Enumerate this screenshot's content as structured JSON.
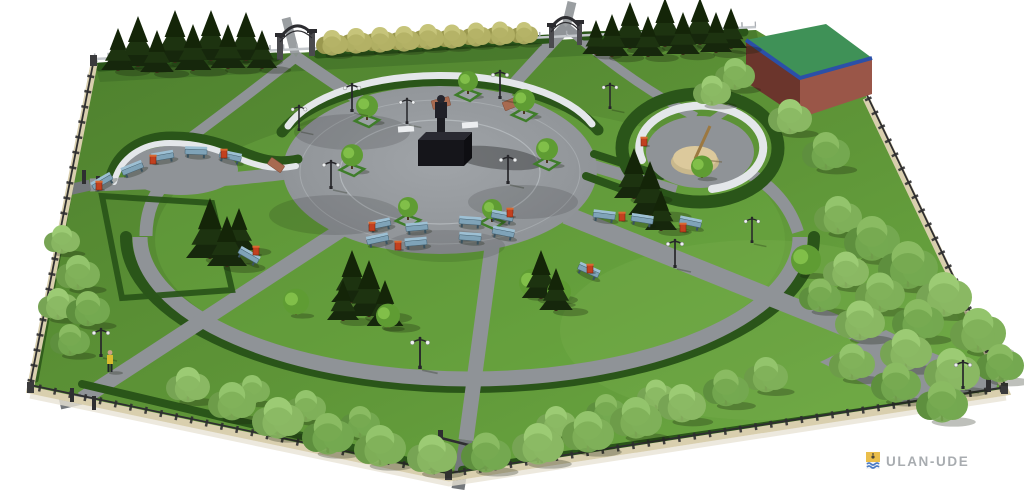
{
  "watermark": {
    "text": "ULAN-UDE"
  },
  "palette": {
    "bg": "#ffffff",
    "lawn_dark": "#4d7f2d",
    "lawn": "#5f9638",
    "lawn_bright": "#6fae45",
    "hedge": "#2a5519",
    "hedge_dark": "#1c3d10",
    "path": "#8f9397",
    "path_dark": "#74787c",
    "path_light": "#a7abaf",
    "plaza_light": "#a0a4a8",
    "plaza": "#8c9094",
    "wall": "#e4e7ea",
    "stone": "#d9cfae",
    "fence": "#2e2e30",
    "rail_light": "#c3c7cb",
    "bench": "#7fa3b8",
    "bench_back": "#9dc0d4",
    "bench_leg": "#39525f",
    "bin": "#c2401f",
    "bin_top": "#d96a33",
    "statue": "#15151a",
    "sundial_base": "#dcc99c",
    "gnomon": "#9c7840",
    "roof": "#3f9157",
    "roof_trim": "#2b50a8",
    "wall_maroon": "#6b352c",
    "wall_pink": "#9a5648",
    "steps": "#a86a50",
    "shadow": "rgba(20,28,12,0.28)",
    "watermark_text": "#898f94",
    "crest_gold": "#e9b93c",
    "crest_blue": "#3a6fc0"
  },
  "scene": {
    "trees": [
      [
        "c",
        118,
        70,
        42
      ],
      [
        "c",
        138,
        66,
        50
      ],
      [
        "c",
        157,
        72,
        42
      ],
      [
        "c",
        175,
        62,
        52
      ],
      [
        "c",
        193,
        70,
        46
      ],
      [
        "c",
        211,
        60,
        50
      ],
      [
        "c",
        228,
        68,
        44
      ],
      [
        "c",
        246,
        60,
        48
      ],
      [
        "c",
        262,
        68,
        38
      ],
      [
        "c",
        596,
        54,
        34
      ],
      [
        "c",
        612,
        56,
        42
      ],
      [
        "c",
        630,
        48,
        46
      ],
      [
        "c",
        648,
        56,
        40
      ],
      [
        "c",
        665,
        46,
        48
      ],
      [
        "c",
        683,
        54,
        42
      ],
      [
        "c",
        700,
        44,
        46
      ],
      [
        "c",
        716,
        52,
        40
      ],
      [
        "c",
        731,
        48,
        40
      ],
      [
        "c",
        210,
        258,
        60
      ],
      [
        "c",
        227,
        266,
        50
      ],
      [
        "c",
        239,
        250,
        42
      ],
      [
        "c",
        352,
        302,
        52
      ],
      [
        "c",
        369,
        316,
        56
      ],
      [
        "c",
        385,
        326,
        46
      ],
      [
        "c",
        343,
        320,
        40
      ],
      [
        "c",
        541,
        298,
        48
      ],
      [
        "c",
        556,
        310,
        42
      ],
      [
        "c",
        634,
        198,
        50
      ],
      [
        "c",
        650,
        215,
        54
      ],
      [
        "c",
        661,
        230,
        40
      ],
      [
        "d",
        838,
        232,
        24
      ],
      [
        "d",
        872,
        258,
        28
      ],
      [
        "d",
        908,
        286,
        30
      ],
      [
        "d",
        944,
        314,
        28
      ],
      [
        "d",
        978,
        350,
        28
      ],
      [
        "d",
        1000,
        380,
        24
      ],
      [
        "d",
        918,
        338,
        26
      ],
      [
        "d",
        880,
        310,
        25
      ],
      [
        "d",
        846,
        286,
        23
      ],
      [
        "d",
        952,
        390,
        28
      ],
      [
        "d",
        906,
        368,
        26
      ],
      [
        "d",
        860,
        338,
        25
      ],
      [
        "d",
        820,
        310,
        21
      ],
      [
        "d",
        942,
        420,
        26
      ],
      [
        "d",
        896,
        400,
        25
      ],
      [
        "d",
        852,
        378,
        23
      ],
      [
        "d",
        188,
        400,
        22
      ],
      [
        "d",
        232,
        418,
        24
      ],
      [
        "d",
        278,
        436,
        26
      ],
      [
        "d",
        328,
        452,
        26
      ],
      [
        "d",
        380,
        464,
        26
      ],
      [
        "d",
        432,
        472,
        25
      ],
      [
        "d",
        486,
        470,
        25
      ],
      [
        "d",
        538,
        462,
        26
      ],
      [
        "d",
        588,
        450,
        26
      ],
      [
        "d",
        636,
        436,
        26
      ],
      [
        "d",
        682,
        420,
        24
      ],
      [
        "d",
        726,
        404,
        23
      ],
      [
        "d",
        766,
        390,
        22
      ],
      [
        "d",
        252,
        402,
        18
      ],
      [
        "d",
        306,
        420,
        20
      ],
      [
        "d",
        360,
        436,
        20
      ],
      [
        "d",
        556,
        436,
        20
      ],
      [
        "d",
        606,
        424,
        20
      ],
      [
        "d",
        656,
        408,
        19
      ],
      [
        "d",
        62,
        252,
        18
      ],
      [
        "d",
        78,
        288,
        22
      ],
      [
        "d",
        58,
        318,
        20
      ],
      [
        "d",
        88,
        324,
        22
      ],
      [
        "d",
        70,
        354,
        20
      ],
      [
        "d",
        735,
        88,
        20
      ],
      [
        "d",
        712,
        104,
        19
      ],
      [
        "d",
        790,
        132,
        22
      ],
      [
        "d",
        826,
        168,
        24
      ],
      [
        "y",
        332,
        54,
        16
      ],
      [
        "y",
        356,
        52,
        16
      ],
      [
        "y",
        380,
        51,
        16
      ],
      [
        "y",
        404,
        50,
        16
      ],
      [
        "y",
        428,
        48,
        16
      ],
      [
        "y",
        452,
        47,
        15
      ],
      [
        "y",
        476,
        45,
        15
      ],
      [
        "y",
        500,
        44,
        15
      ],
      [
        "y",
        524,
        43,
        14
      ],
      [
        "t",
        296,
        314,
        13
      ],
      [
        "t",
        388,
        327,
        12
      ],
      [
        "t",
        533,
        296,
        14
      ],
      [
        "t",
        559,
        303,
        12
      ],
      [
        "t",
        806,
        274,
        15
      ],
      [
        "t",
        702,
        177,
        11
      ],
      [
        "p",
        367,
        120,
        11
      ],
      [
        "p",
        352,
        169,
        11
      ],
      [
        "p",
        468,
        94,
        10
      ],
      [
        "p",
        524,
        114,
        11
      ],
      [
        "p",
        547,
        163,
        11
      ],
      [
        "p",
        408,
        220,
        10
      ],
      [
        "p",
        492,
        222,
        10
      ]
    ],
    "benches": [
      [
        380,
        226,
        -12
      ],
      [
        417,
        229,
        -5
      ],
      [
        470,
        223,
        4
      ],
      [
        502,
        218,
        11
      ],
      [
        378,
        241,
        -12
      ],
      [
        416,
        244,
        -5
      ],
      [
        470,
        239,
        4
      ],
      [
        503,
        234,
        11
      ],
      [
        103,
        183,
        -30
      ],
      [
        133,
        170,
        -22
      ],
      [
        163,
        158,
        -10
      ],
      [
        196,
        153,
        2
      ],
      [
        230,
        158,
        12
      ],
      [
        604,
        217,
        7
      ],
      [
        642,
        221,
        9
      ],
      [
        690,
        224,
        12
      ],
      [
        588,
        272,
        24
      ],
      [
        248,
        257,
        30
      ]
    ],
    "bins": [
      [
        372,
        228
      ],
      [
        510,
        214
      ],
      [
        398,
        247
      ],
      [
        99,
        187
      ],
      [
        153,
        161
      ],
      [
        224,
        155
      ],
      [
        622,
        218
      ],
      [
        683,
        229
      ],
      [
        256,
        252
      ],
      [
        590,
        270
      ],
      [
        644,
        143
      ]
    ],
    "lamps": [
      [
        352,
        112,
        1
      ],
      [
        407,
        124,
        0.9
      ],
      [
        500,
        99,
        1
      ],
      [
        331,
        189,
        1
      ],
      [
        508,
        184,
        1
      ],
      [
        299,
        131,
        0.9
      ],
      [
        610,
        109,
        0.9
      ],
      [
        675,
        268,
        1
      ],
      [
        420,
        369,
        1.1
      ],
      [
        101,
        357,
        1
      ],
      [
        963,
        389,
        1
      ],
      [
        752,
        243,
        0.9
      ]
    ],
    "person": [
      110,
      372
    ]
  }
}
